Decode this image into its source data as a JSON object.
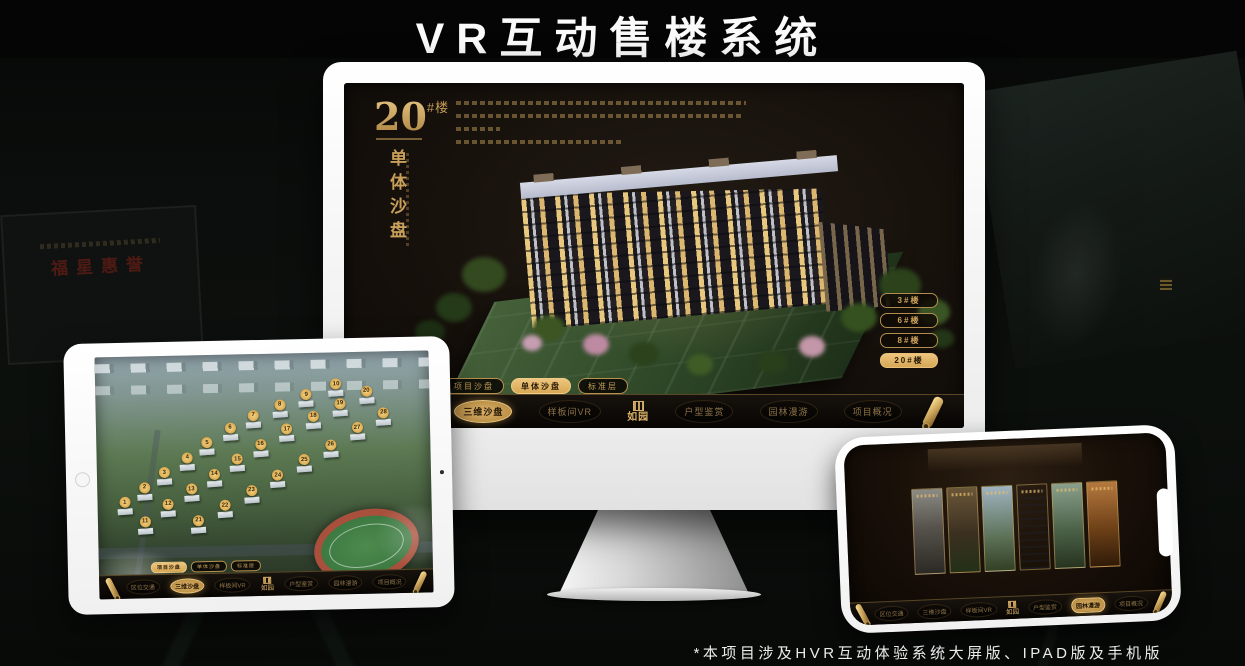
{
  "page": {
    "title": "VR互动售楼系统",
    "footnote": "*本项目涉及HVR互动体验系统大屏版、IPAD版及手机版"
  },
  "colors": {
    "gold": "#cfa45f",
    "gold_bright": "#e8c27a",
    "screen_bg": "#15100b",
    "background": "#0b0e0c"
  },
  "background_plaque": {
    "text": "福星惠誉"
  },
  "monitor": {
    "headline": {
      "number": "20",
      "suffix": "#楼",
      "subtitle": "单体沙盘"
    },
    "floor_buttons": [
      {
        "label": "3#楼",
        "selected": false
      },
      {
        "label": "6#楼",
        "selected": false
      },
      {
        "label": "8#楼",
        "selected": false
      },
      {
        "label": "20#楼",
        "selected": true
      }
    ],
    "sub_tabs": [
      {
        "label": "项目沙盘",
        "selected": false
      },
      {
        "label": "单体沙盘",
        "selected": true
      },
      {
        "label": "标准层",
        "selected": false
      }
    ],
    "nav": {
      "logo": "如园",
      "items": [
        {
          "label": "区位交通",
          "selected": false
        },
        {
          "label": "三维沙盘",
          "selected": true
        },
        {
          "label": "样板间VR",
          "selected": false
        },
        {
          "label": "户型鉴赏",
          "selected": false
        },
        {
          "label": "园林漫游",
          "selected": false
        },
        {
          "label": "项目概况",
          "selected": false
        }
      ]
    }
  },
  "tablet": {
    "sub_tabs": [
      {
        "label": "项目沙盘",
        "selected": true
      },
      {
        "label": "单体沙盘",
        "selected": false
      },
      {
        "label": "标准层",
        "selected": false
      }
    ],
    "nav": {
      "logo": "如园",
      "items": [
        {
          "label": "区位交通",
          "selected": false
        },
        {
          "label": "三维沙盘",
          "selected": true
        },
        {
          "label": "样板间VR",
          "selected": false
        },
        {
          "label": "户型鉴赏",
          "selected": false
        },
        {
          "label": "园林漫游",
          "selected": false
        },
        {
          "label": "项目概况",
          "selected": false
        }
      ]
    },
    "markers": [
      {
        "n": "1",
        "x": 8,
        "y": 60
      },
      {
        "n": "2",
        "x": 14,
        "y": 54
      },
      {
        "n": "3",
        "x": 20,
        "y": 48
      },
      {
        "n": "4",
        "x": 27,
        "y": 42
      },
      {
        "n": "5",
        "x": 33,
        "y": 36
      },
      {
        "n": "6",
        "x": 40,
        "y": 30
      },
      {
        "n": "7",
        "x": 47,
        "y": 25
      },
      {
        "n": "8",
        "x": 55,
        "y": 21
      },
      {
        "n": "9",
        "x": 63,
        "y": 17
      },
      {
        "n": "10",
        "x": 72,
        "y": 13
      },
      {
        "n": "11",
        "x": 14,
        "y": 68
      },
      {
        "n": "12",
        "x": 21,
        "y": 61
      },
      {
        "n": "13",
        "x": 28,
        "y": 55
      },
      {
        "n": "14",
        "x": 35,
        "y": 49
      },
      {
        "n": "15",
        "x": 42,
        "y": 43
      },
      {
        "n": "16",
        "x": 49,
        "y": 37
      },
      {
        "n": "17",
        "x": 57,
        "y": 31
      },
      {
        "n": "18",
        "x": 65,
        "y": 26
      },
      {
        "n": "19",
        "x": 73,
        "y": 21
      },
      {
        "n": "20",
        "x": 81,
        "y": 16
      },
      {
        "n": "21",
        "x": 30,
        "y": 68
      },
      {
        "n": "22",
        "x": 38,
        "y": 62
      },
      {
        "n": "23",
        "x": 46,
        "y": 56
      },
      {
        "n": "24",
        "x": 54,
        "y": 50
      },
      {
        "n": "25",
        "x": 62,
        "y": 44
      },
      {
        "n": "26",
        "x": 70,
        "y": 38
      },
      {
        "n": "27",
        "x": 78,
        "y": 31
      },
      {
        "n": "28",
        "x": 86,
        "y": 25
      }
    ]
  },
  "phone": {
    "nav": {
      "logo": "如园",
      "items": [
        {
          "label": "区位交通",
          "selected": false
        },
        {
          "label": "三维沙盘",
          "selected": false
        },
        {
          "label": "样板间VR",
          "selected": false
        },
        {
          "label": "户型鉴赏",
          "selected": false
        },
        {
          "label": "园林漫游",
          "selected": true
        },
        {
          "label": "项目概况",
          "selected": false
        }
      ]
    },
    "panels": [
      "courtyard-mono",
      "living-room",
      "balcony-view",
      "building-facade",
      "garden-path",
      "warm-interior"
    ]
  }
}
